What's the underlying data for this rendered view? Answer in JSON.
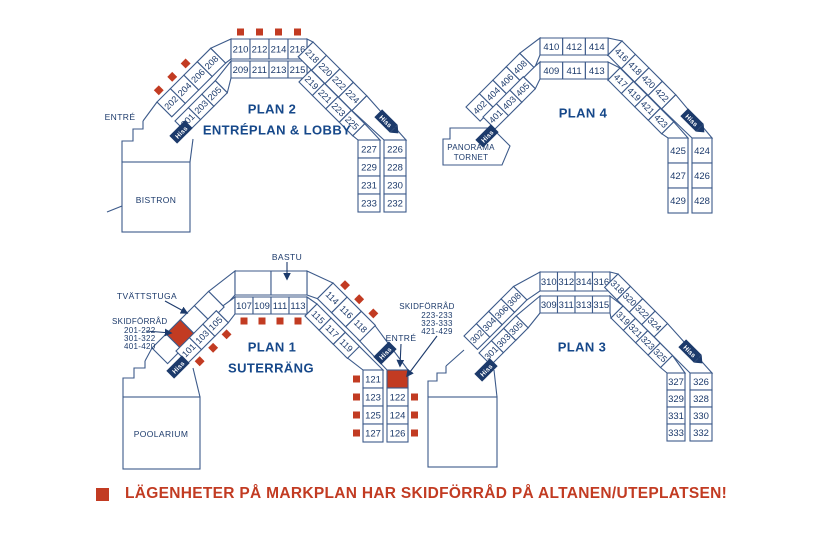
{
  "legend": {
    "text": "LÄGENHETER PÅ MARKPLAN HAR SKIDFÖRRÅD PÅ ALTANEN/UTEPLATSEN!"
  },
  "hiss_label": "Hiss",
  "colors": {
    "line": "#3c5a8a",
    "number": "#1c3a6b",
    "title": "#16488a",
    "red": "#c23b22",
    "hiss_bg": "#1c3a6b",
    "hiss_text": "#ffffff"
  },
  "plans": {
    "plan2": {
      "title": "PLAN 2",
      "subtitle": "ENTRÉPLAN & LOBBY",
      "labels": {
        "entrance": "ENTRÉ",
        "building": "BISTRON"
      },
      "cells": {
        "top_outer": [
          "210",
          "212",
          "214",
          "216"
        ],
        "top_inner": [
          "209",
          "211",
          "213",
          "215"
        ],
        "left_outer": [
          "202",
          "204",
          "206",
          "208"
        ],
        "left_inner": [
          "201",
          "203",
          "205"
        ],
        "right_outer": [
          "218",
          "220",
          "222",
          "224"
        ],
        "right_inner": [
          "219",
          "221",
          "223",
          "225"
        ],
        "col_left": [
          "227",
          "229",
          "231",
          "233"
        ],
        "col_right": [
          "226",
          "228",
          "230",
          "232"
        ]
      },
      "red_marker_cells": {
        "top_outer": [
          0,
          1,
          2,
          3
        ],
        "left_outer": [
          0,
          1,
          2
        ]
      },
      "red_cells": {}
    },
    "plan4": {
      "title": "PLAN 4",
      "subtitle": "",
      "labels": {
        "tower_line1": "PANORAMA",
        "tower_line2": "TORNET"
      },
      "cells": {
        "top_outer": [
          "410",
          "412",
          "414"
        ],
        "top_inner": [
          "409",
          "411",
          "413"
        ],
        "left_outer": [
          "402",
          "404",
          "406",
          "408"
        ],
        "left_inner": [
          "401",
          "403",
          "405"
        ],
        "right_outer": [
          "416",
          "418",
          "420",
          "422"
        ],
        "right_inner": [
          "417",
          "419",
          "421",
          "423"
        ],
        "col_left": [
          "425",
          "427",
          "429"
        ],
        "col_right": [
          "424",
          "426",
          "428"
        ]
      },
      "red_marker_cells": {},
      "red_cells": {}
    },
    "plan1": {
      "title": "PLAN 1",
      "subtitle": "SUTERRÄNG",
      "labels": {
        "bastu": "BASTU",
        "laundry": "TVÄTTSTUGA",
        "ski_left": [
          "SKIDFÖRRÅD",
          "201-222",
          "301-322",
          "401-420"
        ],
        "ski_right": [
          "SKIDFÖRRÅD",
          "223-233",
          "323-333",
          "421-429"
        ],
        "entrance": "ENTRÉ",
        "building": "POOLARIUM"
      },
      "cells": {
        "top_outer": [
          "",
          ""
        ],
        "top_inner": [
          "107",
          "109",
          "111",
          "113"
        ],
        "left_outer": [
          "",
          "",
          "",
          ""
        ],
        "left_inner": [
          "101",
          "103",
          "105"
        ],
        "right_outer": [
          "114",
          "116",
          "118"
        ],
        "right_inner": [
          "115",
          "117",
          "119"
        ],
        "col_left": [
          "121",
          "123",
          "125",
          "127"
        ],
        "col_right": [
          "",
          "122",
          "124",
          "126"
        ]
      },
      "red_marker_cells": {
        "top_inner": [
          0,
          1,
          2,
          3
        ],
        "left_inner": [
          0,
          1,
          2
        ],
        "right_outer": [
          0,
          1,
          2
        ],
        "col_left": [
          0,
          1,
          2,
          3
        ],
        "col_right": [
          1,
          2,
          3
        ]
      },
      "red_cells": {
        "left_outer": [
          1
        ],
        "col_right": [
          0
        ]
      }
    },
    "plan3": {
      "title": "PLAN 3",
      "subtitle": "",
      "labels": {},
      "cells": {
        "top_outer": [
          "310",
          "312",
          "314",
          "316"
        ],
        "top_inner": [
          "309",
          "311",
          "313",
          "315"
        ],
        "left_outer": [
          "302",
          "304",
          "306",
          "308"
        ],
        "left_inner": [
          "301",
          "303",
          "305"
        ],
        "right_outer": [
          "318",
          "320",
          "322",
          "324"
        ],
        "right_inner": [
          "319",
          "321",
          "323",
          "325"
        ],
        "col_left": [
          "327",
          "329",
          "331",
          "333"
        ],
        "col_right": [
          "326",
          "328",
          "330",
          "332"
        ]
      },
      "red_marker_cells": {},
      "red_cells": {}
    }
  }
}
